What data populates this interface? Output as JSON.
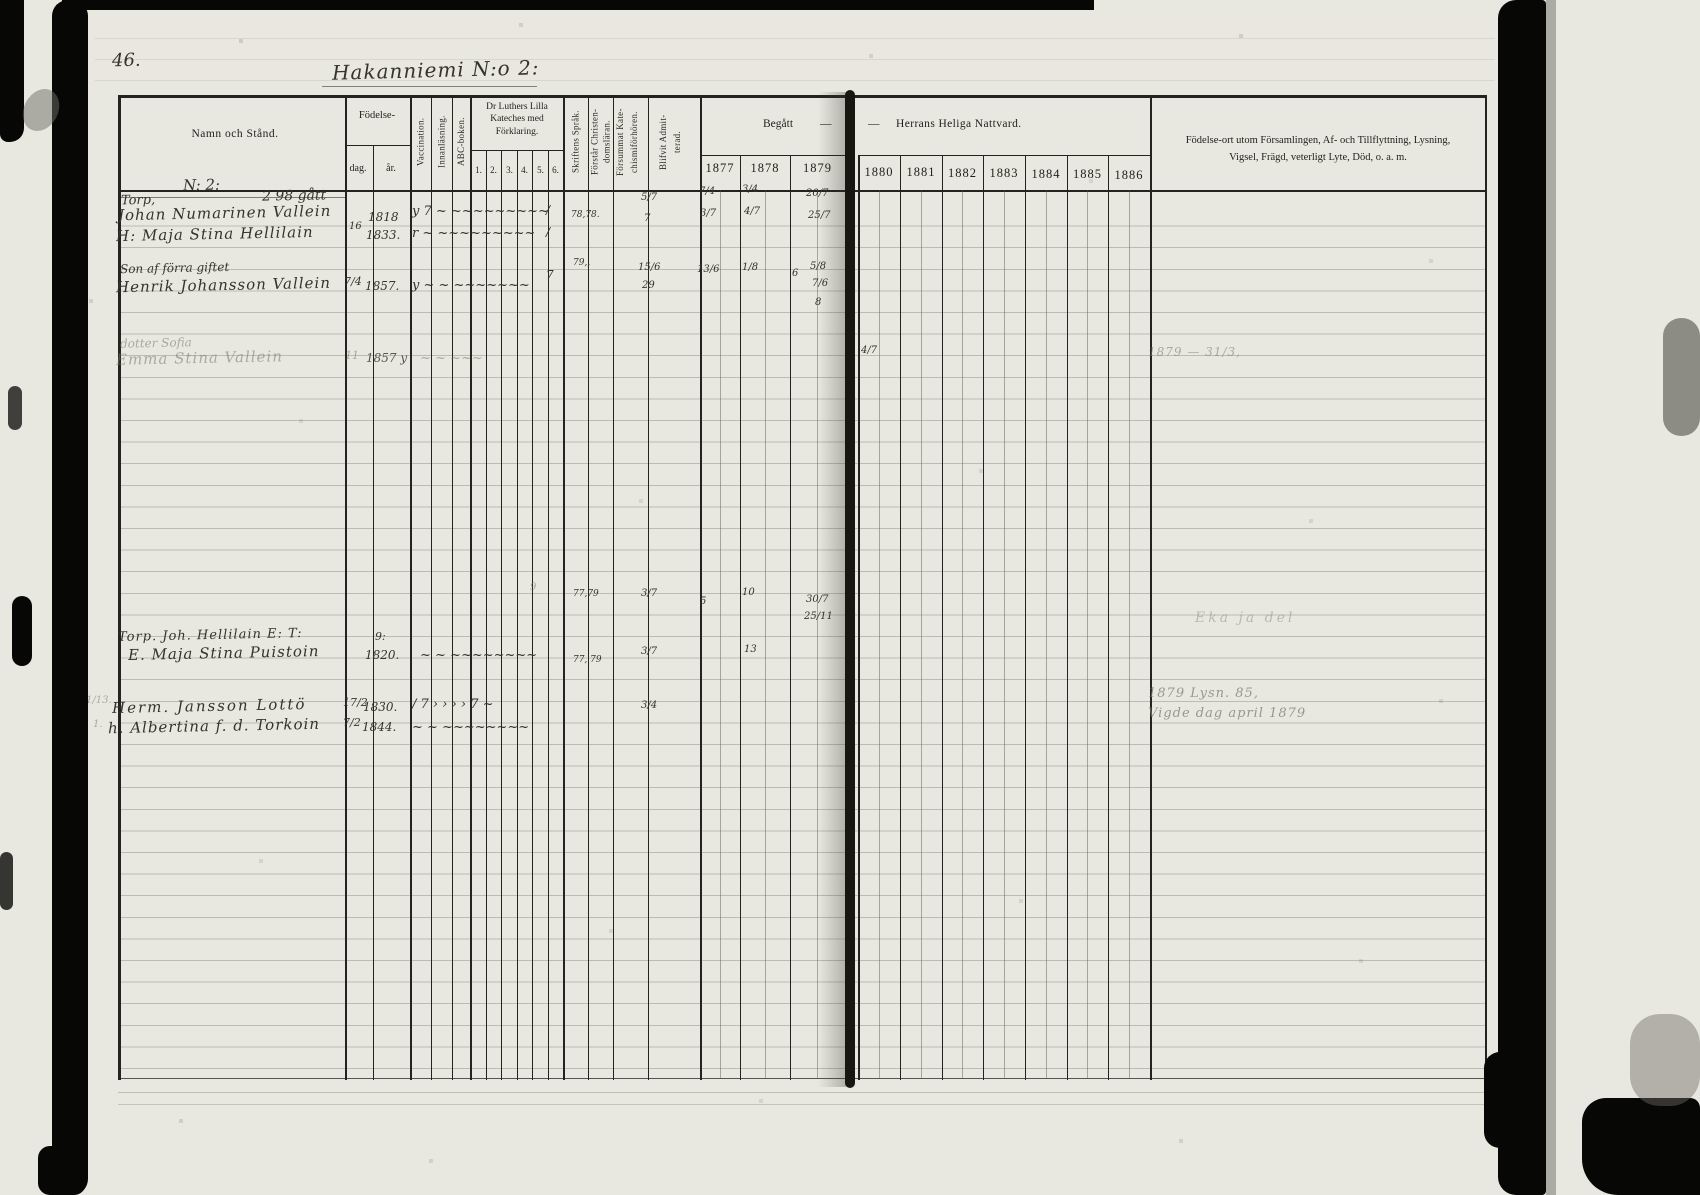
{
  "page": {
    "number": "46.",
    "title": "Hakanniemi N:o 2:"
  },
  "header": {
    "name": "Namn och Stånd.",
    "birth": "Födelse-",
    "birth_day": "dag.",
    "birth_year": "år.",
    "col_vaccination": "Vaccination.",
    "col_reading": "Innanläsning.",
    "col_abc": "ABC-boken.",
    "col_catechism": "Dr Luthers Lilla Kateches med Förklaring.",
    "catechism_nums": {
      "n1": "1.",
      "n2": "2.",
      "n3": "3.",
      "n4": "4.",
      "n5": "5.",
      "n6": "6."
    },
    "col_scripture": "Skriftens Språk.",
    "col_understands_1": "Förstår Christen-",
    "col_understands_2": "domsläran.",
    "col_missed_1": "Försummat Kate-",
    "col_missed_2": "chismiförhören.",
    "col_admitted_1": "Blifvit Admit-",
    "col_admitted_2": "terad.",
    "communion_begatt": "Begått",
    "communion_dash1": "—",
    "communion_dash2": "—",
    "communion_rest": "Herrans Heliga Nattvard.",
    "years": {
      "y1877": "1877",
      "y1878": "1878",
      "y1879": "1879",
      "y1880": "1880",
      "y1881": "1881",
      "y1882": "1882",
      "y1883": "1883",
      "y1884": "1884",
      "y1885": "1885",
      "y1886": "1886"
    },
    "notes_col_line1": "Födelse-ort utom Församlingen, Af- och Tillflyttning, Lysning,",
    "notes_col_line2": "Vigsel, Frägd, veterligt Lyte, Död, o. a. m."
  },
  "entries": {
    "e1": {
      "no": "N: 2:",
      "line": "Torp,",
      "note": "2 98 gått"
    },
    "e2": {
      "name": "Johan Numarinen Vallein",
      "year": "1818",
      "marks": "y 7 ~ ~~~~~~~~~",
      "sk": "/",
      "exam": "78,78.",
      "adm": "5/7",
      "c77": "7/4",
      "c78": "3/4",
      "c79": "20/7"
    },
    "e3": {
      "name": "H: Maja Stina Hellilain",
      "day": "16",
      "year": "1833.",
      "marks": "r ~  ~~~~~~~~~",
      "sk": "/",
      "adm": "7",
      "c77": "3/7",
      "c78": "4/7",
      "c79": "25/7"
    },
    "e4": {
      "line1": "Son af förra giftet",
      "name": "Henrik Johansson Vallein",
      "day": "7/4",
      "year": "1857.",
      "marks": "y ~ ~ ~~~~~~~",
      "sk": "7",
      "exam": "79,,",
      "adm1": "15/6",
      "adm2": "29",
      "c77": "13/6",
      "c78": "1/8",
      "c79a": "6",
      "c79b": "5/8",
      "c79c": "7/6",
      "c79d": "8"
    },
    "e5": {
      "line1": "dotter Sofia",
      "name": "Emma Stina Vallein",
      "day": "11",
      "year": "1857 y",
      "marks": "~ ~  ~~~",
      "c80": "4/7",
      "note": "1879 — 31/3,"
    },
    "e6": {
      "pre": "9",
      "exam": "77,79",
      "adm": "3/7",
      "c77": "5",
      "c78": "10",
      "c79a": "30/7",
      "c79b": "25/11",
      "line1": "Torp. Joh. Hellilain E: T:",
      "day": "9:",
      "name": "E. Maja Stina Puistoin",
      "year": "1820.",
      "marks": "~ ~ ~~~~~~~~",
      "note": "Eka ja del"
    },
    "e7": {
      "margin": "1/13.",
      "exam": "77, 79",
      "adm": "3/7",
      "c78": "13",
      "name": "Herm. Jansson Lottö",
      "day": "17/2",
      "year": "1830.",
      "marks": "/ 7 › › › › 7 ~"
    },
    "e8": {
      "margin": "1.",
      "adm": "3/4",
      "name": "h. Albertina f. d. Torkoin",
      "day": "7/2",
      "year": "1844.",
      "marks": "~ ~ ~~~~~~~~",
      "note1": "1879 Lysn. 85,",
      "note2": "Vigde dag april 1879"
    }
  }
}
